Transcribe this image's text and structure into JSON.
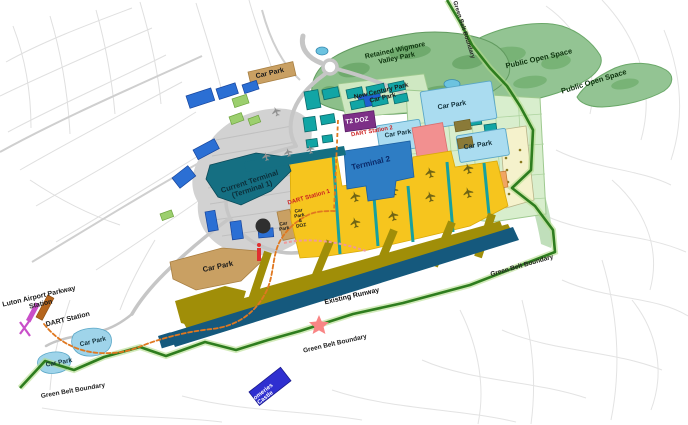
{
  "labels": {
    "car_park_top": "Car Park",
    "retained_wigmore_valley_park": "Retained Wigmore\nValley Park",
    "public_open_space_upper": "Public Open Space",
    "public_open_space_right": "Public Open Space",
    "green_belt_boundary_top": "Green Belt Boundary",
    "new_century_park_car_park": "New Century Park\nCar Park",
    "t2_doz": "T2 DOZ",
    "dart_station_2": "DART Station 2",
    "terminal_2": "Terminal 2",
    "car_park_t2_west": "Car Park",
    "car_park_east_upper": "Car Park",
    "car_park_east_lower": "Car Park",
    "current_terminal": "Current Terminal\n(Terminal 1)",
    "dart_station_1": "DART Station 1",
    "car_park_doz_left": "Car\nPark",
    "car_park_doz_right": "Car\nPark\n&\nDOZ",
    "car_park_mid_tan": "Car Park",
    "existing_runway": "Existing Runway",
    "green_belt_boundary_right": "Green Belt Boundary",
    "green_belt_boundary_mid": "Green Belt Boundary",
    "green_belt_boundary_left": "Green Belt Boundary",
    "luton_airport_parkway_station": "Luton Airport Parkway\nStation",
    "dart_station": "DART Station",
    "car_park_west_upper": "Car Park",
    "car_park_west_lower": "Car Park",
    "someries_castle": "Someries\nCastle"
  },
  "palette": {
    "green_belt_line": "#2e7d1e",
    "public_open_space_green": "#93c493",
    "park_green": "#8cbf8a",
    "terminal_2_blue": "#2e7dc4",
    "current_terminal_teal": "#156f82",
    "car_park_light_blue": "#aadcf0",
    "car_park_tan": "#c9a063",
    "aircraft_stands_yellow": "#f6c51e",
    "taxiway_olive": "#a08e08",
    "runway_blue": "#15597d",
    "t2_doz_purple": "#7d3087",
    "dart_route_orange": "#e07820",
    "someries_castle_blue": "#2f2fd0",
    "star_pink": "#f98585",
    "existing_car_park_blue": "#2b6fd4",
    "teal_building": "#12a5a5"
  }
}
